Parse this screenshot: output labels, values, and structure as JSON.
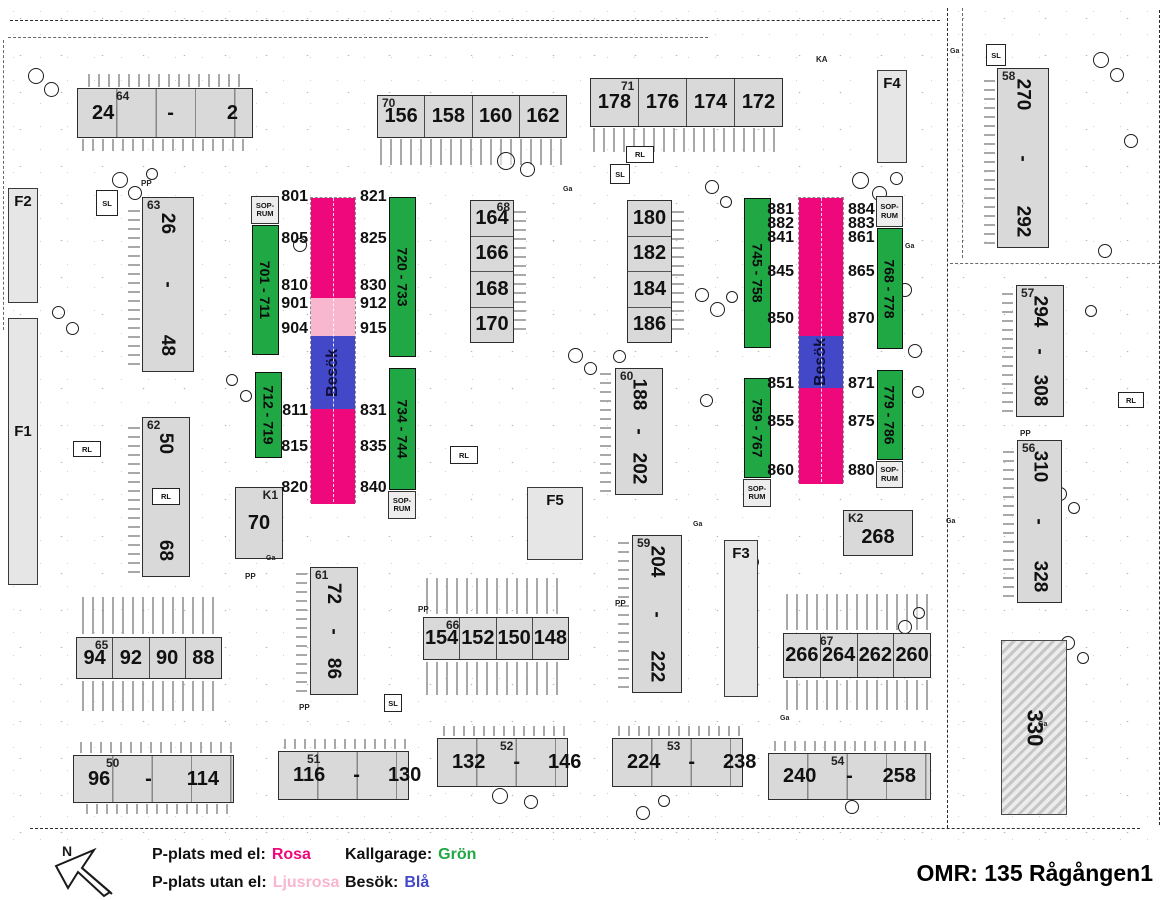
{
  "title": "OMR: 135 Rågången1",
  "compass": {
    "n": "N"
  },
  "colors": {
    "rosa": "#EE087B",
    "ljusrosa": "#F9B6CF",
    "gron": "#1FA844",
    "bla": "#4348C8",
    "building": "#D9D9D9"
  },
  "legend": {
    "med_el_label": "P-plats med el:",
    "med_el_value": "Rosa",
    "utan_el_label": "P-plats utan el:",
    "utan_el_value": "Ljusrosa",
    "kallgarage_label": "Kallgarage:",
    "kallgarage_value": "Grön",
    "besok_label": "Besök:",
    "besok_value": "Blå"
  },
  "labels": {
    "sop_line1": "SOP-",
    "sop_line2": "RUM",
    "besok": "Besök",
    "sl": "SL",
    "rl": "RL",
    "pp": "PP",
    "ga": "Ga",
    "ka": "KA"
  },
  "buildings": {
    "b64": {
      "id": "64",
      "units": [
        "24",
        "-",
        "2"
      ]
    },
    "b70": {
      "id": "70",
      "units": [
        "156",
        "158",
        "160",
        "162"
      ]
    },
    "b71": {
      "id": "71",
      "units": [
        "178",
        "176",
        "174",
        "172"
      ]
    },
    "f4": {
      "id": "F4"
    },
    "b58": {
      "id": "58",
      "units": [
        "270",
        "-",
        "292"
      ]
    },
    "f2": {
      "id": "F2"
    },
    "f1": {
      "id": "F1"
    },
    "b63": {
      "id": "63",
      "units": [
        "26",
        "-",
        "48"
      ]
    },
    "b62": {
      "id": "62",
      "units": [
        "50",
        "-",
        "68"
      ]
    },
    "k1": {
      "id": "K1",
      "units": [
        "70"
      ]
    },
    "b68": {
      "id": "68",
      "units": [
        "164",
        "166",
        "168",
        "170"
      ]
    },
    "b180": {
      "units": [
        "180",
        "182",
        "184",
        "186"
      ]
    },
    "b60": {
      "id": "60",
      "units": [
        "188",
        "-",
        "202"
      ]
    },
    "f5": {
      "id": "F5"
    },
    "b59": {
      "id": "59",
      "units": [
        "204",
        "-",
        "222"
      ]
    },
    "f3": {
      "id": "F3"
    },
    "k2": {
      "id": "K2",
      "units": [
        "268"
      ]
    },
    "b67": {
      "id": "67",
      "units": [
        "266",
        "264",
        "262",
        "260"
      ]
    },
    "b57": {
      "id": "57",
      "units": [
        "294",
        "-",
        "308"
      ]
    },
    "b56": {
      "id": "56",
      "units": [
        "310",
        "-",
        "328"
      ]
    },
    "b330": {
      "units": [
        "330"
      ]
    },
    "b65": {
      "id": "65",
      "units": [
        "94",
        "92",
        "90",
        "88"
      ]
    },
    "b61": {
      "id": "61",
      "units": [
        "72",
        "-",
        "86"
      ]
    },
    "b66": {
      "id": "66",
      "units": [
        "154",
        "152",
        "150",
        "148"
      ]
    },
    "b50": {
      "id": "50",
      "units": [
        "96",
        "-",
        "114"
      ]
    },
    "b51": {
      "id": "51",
      "units": [
        "116",
        "-",
        "130"
      ]
    },
    "b52": {
      "id": "52",
      "units": [
        "132",
        "-",
        "146"
      ]
    },
    "b53": {
      "id": "53",
      "units": [
        "224",
        "-",
        "238"
      ]
    },
    "b54": {
      "id": "54",
      "units": [
        "240",
        "-",
        "258"
      ]
    }
  },
  "parking": {
    "garages": {
      "g701": "701 - 711",
      "g712": "712 - 719",
      "g720": "720 - 733",
      "g734": "734 - 744",
      "g745": "745 - 758",
      "g759": "759 - 767",
      "g768": "768 - 778",
      "g779": "779 - 786"
    },
    "left_strip": {
      "west": [
        "801",
        "805",
        "810",
        "901",
        "904",
        "811",
        "815",
        "820"
      ],
      "east": [
        "821",
        "825",
        "830",
        "912",
        "915",
        "831",
        "835",
        "840"
      ]
    },
    "right_strip": {
      "west": [
        "881",
        "882",
        "841",
        "845",
        "850",
        "851",
        "855",
        "860"
      ],
      "east": [
        "884",
        "883",
        "861",
        "865",
        "870",
        "871",
        "875",
        "880"
      ]
    }
  }
}
